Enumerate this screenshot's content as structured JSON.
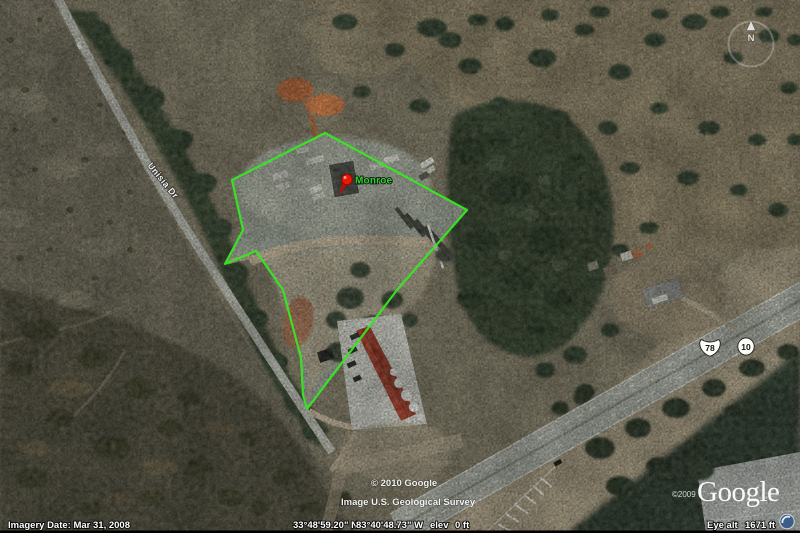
{
  "overlay": {
    "placemark_label": "Monroe",
    "street_label": "Unisia Dr",
    "shield_us78": "78",
    "shield_ga10": "10",
    "compass_north": "N"
  },
  "watermarks": {
    "map_copyright": "© 2010 Google",
    "imagery_credit": "Image U.S. Geological Survey",
    "logo_text": "Google",
    "logo_copyright": "©2009"
  },
  "status_bar": {
    "imagery_date": "Imagery Date: Mar 31, 2008",
    "latitude": "33°48'59.20\" N",
    "longitude": "83°40'48.73\" W",
    "elev_label": "elev",
    "elev_value": "0 ft",
    "eye_alt_label": "Eye alt",
    "eye_alt_value": "1671 ft"
  },
  "colors": {
    "boundary_green": "#38e722",
    "placemark_red": "#ea1608",
    "label_green": "#2fd32f"
  }
}
